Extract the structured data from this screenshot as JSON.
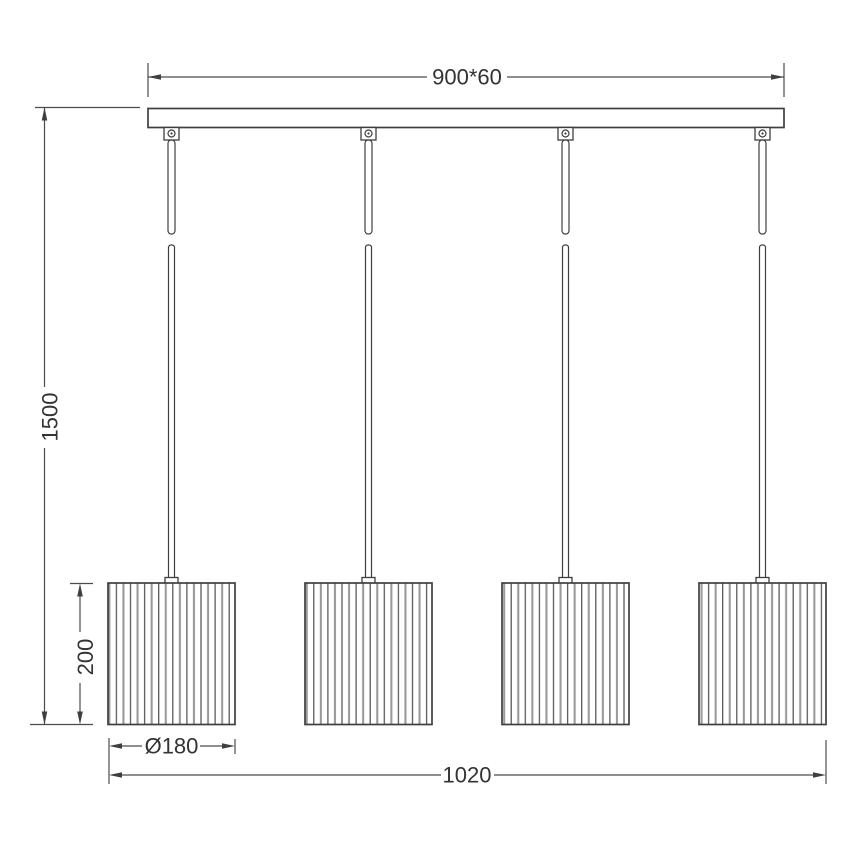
{
  "labels": {
    "canopy_dimension": "900*60",
    "suspension_height": "1500",
    "shade_height": "200",
    "shade_diameter": "Ø180",
    "overall_width": "1020"
  },
  "fixture": {
    "shade_count": 4
  },
  "colors": {
    "background": "#ffffff",
    "outline": "#3f3f3f",
    "dimension_line": "#4c4c4c",
    "pleat_dark": "#4e4e4e",
    "pleat_light": "#9a9a9a",
    "text": "#333333"
  }
}
